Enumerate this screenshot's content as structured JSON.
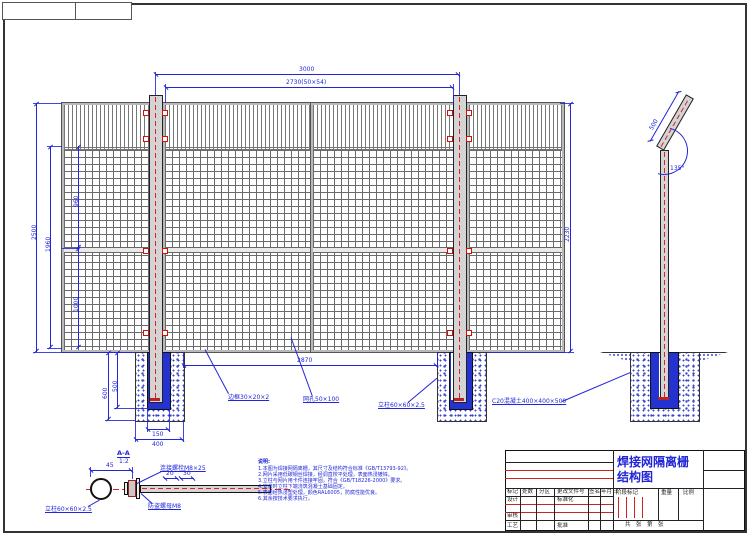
{
  "drawing": {
    "title": {
      "line1": "焊接网隔离栅",
      "line2": "结构图"
    },
    "dims": {
      "post_spacing": "3000",
      "panel_width": "2730(50×54)",
      "total_height": "2500",
      "mesh_height": "1960",
      "seg_upper": "960",
      "seg_lower": "1000",
      "right_height": "2230",
      "clear_span": "2870",
      "pocket_depth": "500",
      "found_depth": "600",
      "pocket_width": "150",
      "found_width": "400",
      "arm_length": "500",
      "arm_angle": "135°",
      "bolt_dim": "45",
      "nut_dim1": "20",
      "nut_dim2": "30"
    },
    "labels": {
      "frame": "边框30×20×2",
      "mesh_opening": "网孔50×100",
      "post": "立柱60×60×2.5",
      "concrete": "C20混凝土400×400×500",
      "bolt": "连接螺栓M8×25",
      "nut": "防盗螺母M8",
      "section_post": "立柱60×60×2.5",
      "section_title": "A-A",
      "section_scale": "1:2"
    },
    "notes": {
      "title": "说明:",
      "lines": [
        "1.本图为焊接网隔离栅，其尺寸及结构符合标准《GB/T13793-92》。",
        "2.网片采用低碳钢丝焊接，经调直校平处理，表面热浸镀锌。",
        "3.立柱与网片用卡件连接牢固，符合《GB/T18226-2000》要求。",
        "4.安装时立柱下端浇筑混凝土基础固定。",
        "5.表面经热浸塑处理，颜色RAL6005，防腐性能优良。",
        "6.其余按技术要求执行。"
      ]
    },
    "titleblock": {
      "mark": "标记",
      "count": "处数",
      "zone": "分区",
      "change_no": "更改文件号",
      "sign": "签名",
      "date": "年月日",
      "design": "设计",
      "standard": "标准化",
      "check": "审核",
      "process": "工艺",
      "approve": "批准",
      "stage": "阶段标记",
      "weight": "重量",
      "scale": "比例",
      "sheet": "共　张　第　张"
    },
    "colors": {
      "dim_blue": "#2126d6",
      "accent_red": "#cc2222",
      "line_black": "#222222"
    }
  }
}
